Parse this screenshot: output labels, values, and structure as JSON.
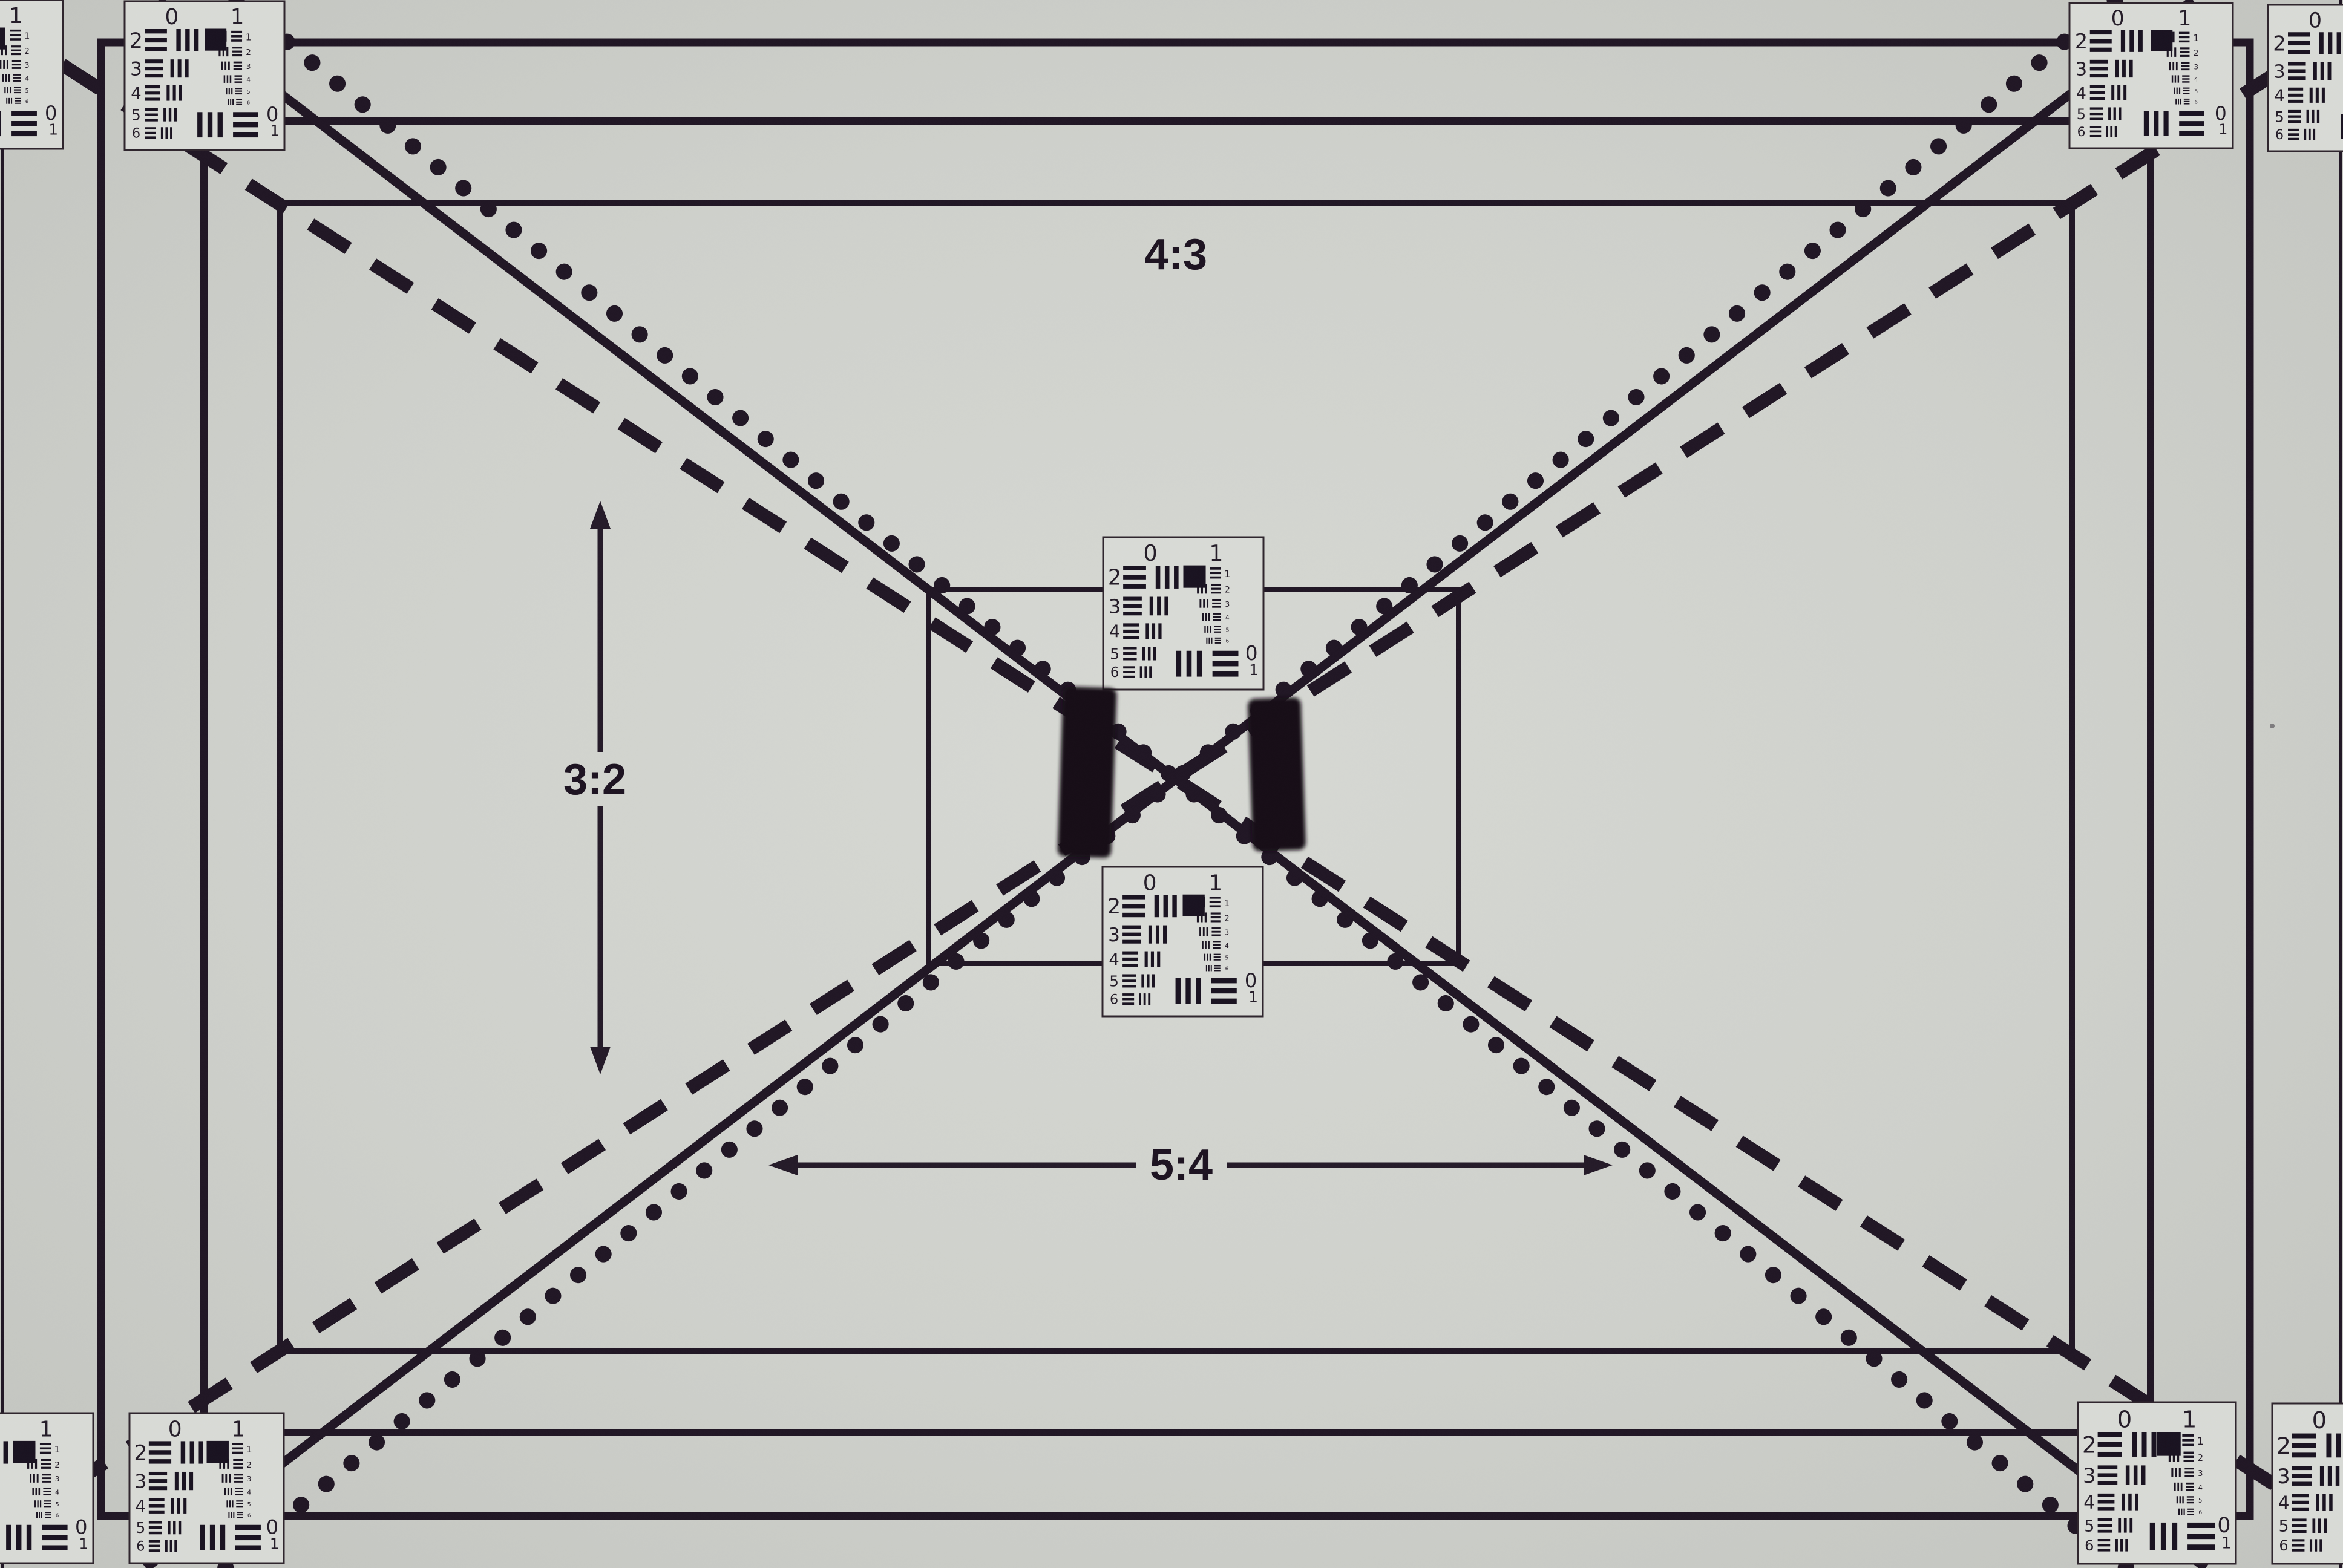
{
  "aspect_labels": {
    "top": "4:3",
    "left": "3:2",
    "bottom": "5:4"
  },
  "usaf_target": {
    "top_labels": [
      "0",
      "1"
    ],
    "left_row_numbers": [
      "2",
      "3",
      "4",
      "5",
      "6"
    ],
    "right_element_numbers": [
      "1",
      "2",
      "3",
      "4",
      "5",
      "6"
    ],
    "bottom_labels": [
      "0",
      "1"
    ]
  },
  "colors": {
    "background_center": "#d7d9d4",
    "background_edge": "#c2c4bf",
    "line_ink": "#201624",
    "card_background": "#d9dbd6",
    "bar_ink": "#191220",
    "small_number_ink": "#6e676d",
    "patch_black": "#131114"
  }
}
